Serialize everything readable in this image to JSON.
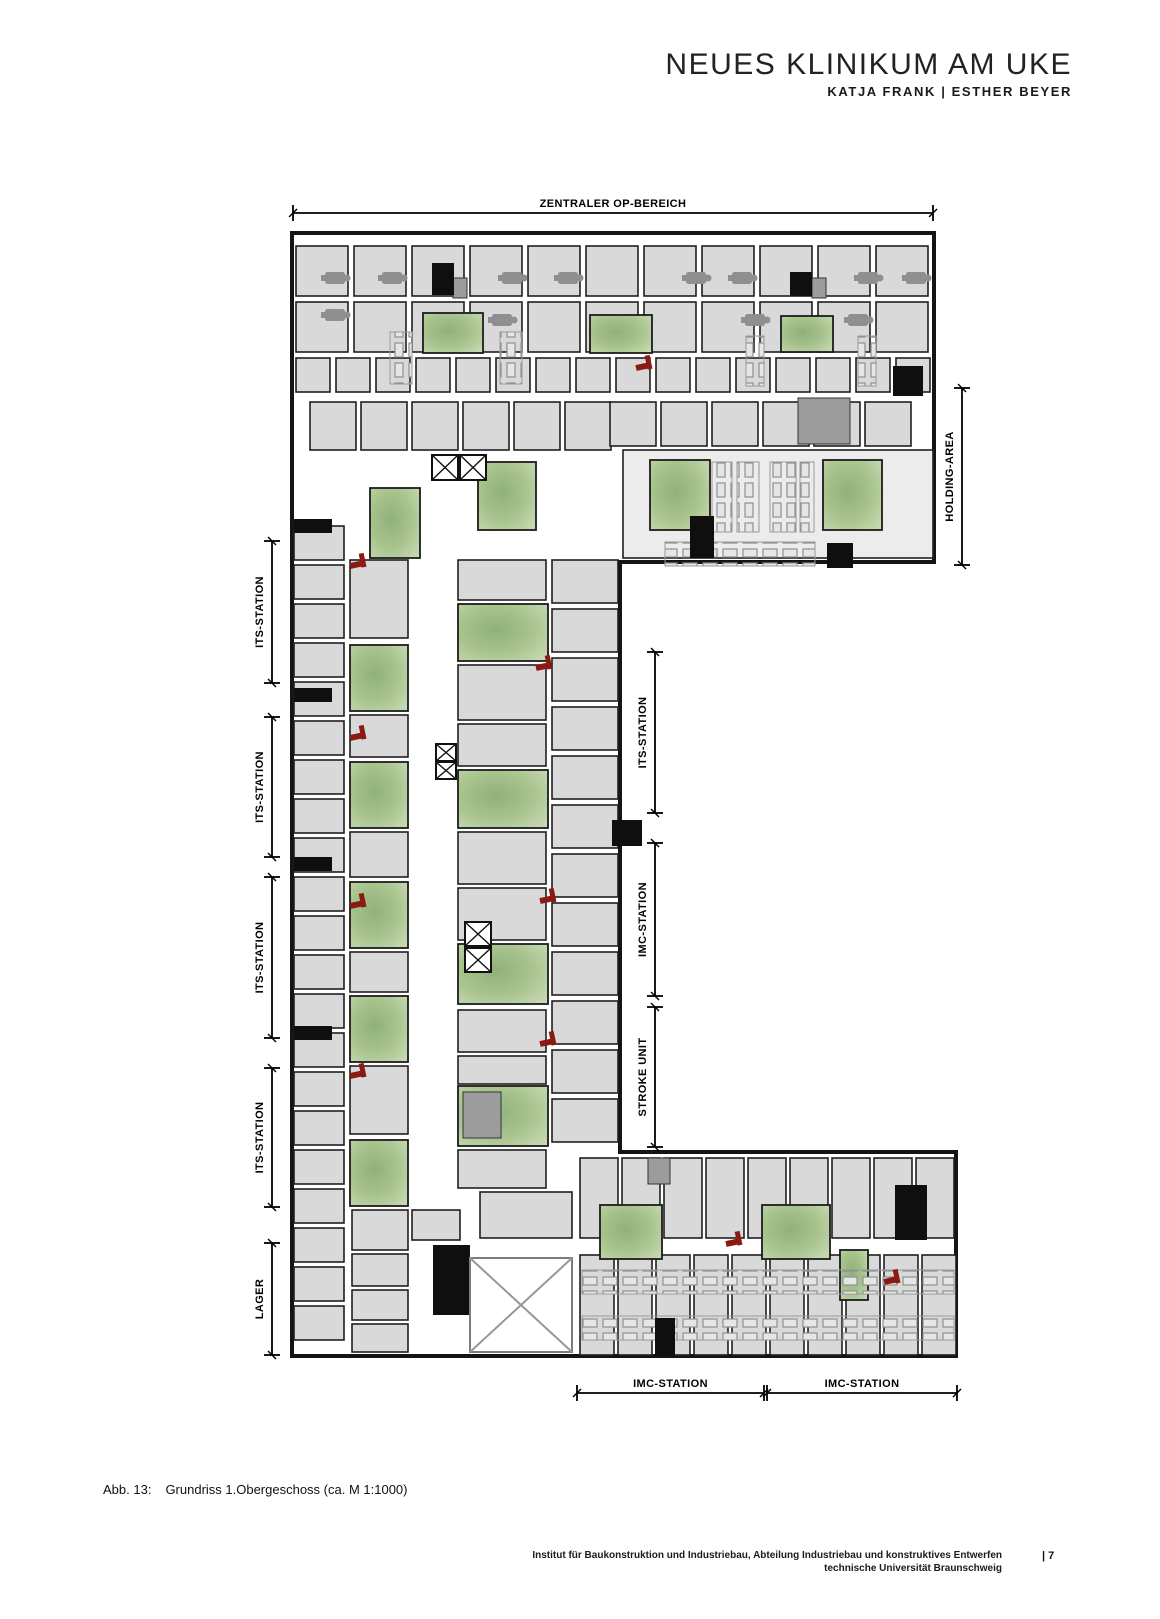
{
  "header": {
    "title": "NEUES KLINIKUM AM UKE",
    "subtitle": "KATJA FRANK | ESTHER BEYER"
  },
  "caption": {
    "label": "Abb. 13:",
    "text": "Grundriss 1.Obergeschoss (ca. M 1:1000)"
  },
  "footer": {
    "line1": "Institut für Baukonstruktion und Industriebau, Abteilung Industriebau und konstruktives Entwerfen",
    "line2": "technische Universität Braunschweig",
    "page": "| 7"
  },
  "colors": {
    "wall": "#141414",
    "room": "#d9d9d9",
    "room_light": "#ececec",
    "green_dark": "#90b07a",
    "green_mid": "#a9c48e",
    "green_light": "#c8dab4",
    "red": "#8b1a12",
    "gray": "#8f8f8f",
    "dim": "#000000"
  },
  "plan": {
    "outline": [
      [
        292,
        233
      ],
      [
        934,
        233
      ],
      [
        934,
        562
      ],
      [
        620,
        562
      ],
      [
        620,
        1152
      ],
      [
        956,
        1152
      ],
      [
        956,
        1356
      ],
      [
        292,
        1356
      ]
    ],
    "room_grids": [
      {
        "x": 296,
        "y": 246,
        "w": 52,
        "h": 50,
        "gap": 6,
        "cols": 11
      },
      {
        "x": 296,
        "y": 302,
        "w": 52,
        "h": 50,
        "gap": 6,
        "cols": 11
      },
      {
        "x": 296,
        "y": 358,
        "w": 34,
        "h": 34,
        "gap": 6,
        "cols": 16
      },
      {
        "x": 310,
        "y": 402,
        "w": 46,
        "h": 48,
        "gap": 5,
        "cols": 6
      },
      {
        "x": 610,
        "y": 402,
        "w": 46,
        "h": 44,
        "gap": 5,
        "cols": 6
      },
      {
        "x": 580,
        "y": 1158,
        "w": 38,
        "h": 80,
        "gap": 4,
        "cols": 9
      },
      {
        "x": 580,
        "y": 1255,
        "w": 34,
        "h": 100,
        "gap": 4,
        "cols": 10
      }
    ],
    "room_stacks": [
      {
        "x": 294,
        "y": 526,
        "w": 50,
        "h": 34,
        "gap": 5,
        "rows": 21
      },
      {
        "x": 552,
        "y": 560,
        "w": 66,
        "h": 43,
        "gap": 6,
        "rows": 12
      }
    ],
    "rooms": [
      [
        623,
        450,
        310,
        108,
        "light"
      ],
      [
        350,
        560,
        58,
        78
      ],
      [
        350,
        715,
        58,
        42
      ],
      [
        350,
        832,
        58,
        45
      ],
      [
        350,
        952,
        58,
        40
      ],
      [
        350,
        1066,
        58,
        68
      ],
      [
        352,
        1210,
        56,
        40
      ],
      [
        352,
        1254,
        56,
        32
      ],
      [
        352,
        1290,
        56,
        30
      ],
      [
        352,
        1324,
        56,
        28
      ],
      [
        458,
        560,
        88,
        40
      ],
      [
        458,
        665,
        88,
        55
      ],
      [
        458,
        724,
        88,
        42
      ],
      [
        458,
        832,
        88,
        52
      ],
      [
        458,
        888,
        88,
        52
      ],
      [
        458,
        1010,
        88,
        42
      ],
      [
        458,
        1056,
        88,
        28
      ],
      [
        458,
        1150,
        88,
        38
      ],
      [
        480,
        1192,
        92,
        46
      ],
      [
        412,
        1210,
        48,
        30
      ]
    ],
    "greens": [
      [
        423,
        313,
        60,
        40
      ],
      [
        590,
        315,
        62,
        38
      ],
      [
        781,
        316,
        52,
        36
      ],
      [
        370,
        488,
        50,
        70
      ],
      [
        478,
        462,
        58,
        68
      ],
      [
        650,
        460,
        60,
        70
      ],
      [
        823,
        460,
        59,
        70
      ],
      [
        350,
        645,
        58,
        66
      ],
      [
        350,
        762,
        58,
        66
      ],
      [
        350,
        882,
        58,
        66
      ],
      [
        350,
        996,
        58,
        66
      ],
      [
        350,
        1140,
        58,
        66
      ],
      [
        458,
        604,
        90,
        57
      ],
      [
        458,
        770,
        90,
        58
      ],
      [
        458,
        944,
        90,
        60
      ],
      [
        458,
        1086,
        90,
        60
      ],
      [
        600,
        1205,
        62,
        54
      ],
      [
        762,
        1205,
        68,
        54
      ],
      [
        840,
        1250,
        28,
        50
      ]
    ],
    "cores": [
      [
        432,
        263,
        22,
        32
      ],
      [
        790,
        272,
        22,
        24
      ],
      [
        893,
        366,
        30,
        30
      ],
      [
        690,
        516,
        24,
        42
      ],
      [
        827,
        543,
        26,
        25
      ],
      [
        294,
        519,
        38,
        14
      ],
      [
        294,
        688,
        38,
        14
      ],
      [
        294,
        857,
        38,
        14
      ],
      [
        294,
        1026,
        38,
        14
      ],
      [
        612,
        820,
        30,
        26
      ],
      [
        433,
        1245,
        37,
        70
      ],
      [
        895,
        1185,
        32,
        55
      ],
      [
        655,
        1318,
        20,
        38
      ]
    ],
    "gray_blocks": [
      [
        453,
        278,
        14,
        20
      ],
      [
        812,
        278,
        14,
        20
      ],
      [
        798,
        398,
        52,
        46
      ],
      [
        463,
        1092,
        38,
        46
      ],
      [
        648,
        1158,
        22,
        26
      ]
    ],
    "xboxes": [
      [
        432,
        455,
        26,
        25
      ],
      [
        460,
        455,
        26,
        25
      ],
      [
        436,
        744,
        20,
        17
      ],
      [
        436,
        762,
        20,
        17
      ],
      [
        465,
        922,
        26,
        24
      ],
      [
        465,
        948,
        26,
        24
      ]
    ],
    "atrium": [
      470,
      1258,
      102,
      94
    ],
    "tables": [
      [
        335,
        278
      ],
      [
        392,
        278
      ],
      [
        512,
        278
      ],
      [
        568,
        278
      ],
      [
        696,
        278
      ],
      [
        742,
        278
      ],
      [
        868,
        278
      ],
      [
        916,
        278
      ],
      [
        335,
        315
      ],
      [
        502,
        320
      ],
      [
        755,
        320
      ],
      [
        858,
        320
      ]
    ],
    "chairs": [
      [
        350,
        566
      ],
      [
        536,
        668
      ],
      [
        350,
        738
      ],
      [
        350,
        906
      ],
      [
        540,
        901
      ],
      [
        350,
        1076
      ],
      [
        540,
        1044
      ],
      [
        726,
        1244
      ],
      [
        884,
        1282
      ],
      [
        636,
        368
      ]
    ],
    "bed_strips_v": [
      [
        712,
        462,
        20,
        70
      ],
      [
        737,
        462,
        22,
        70
      ],
      [
        770,
        462,
        26,
        70
      ],
      [
        800,
        462,
        14,
        70
      ],
      [
        390,
        332,
        22,
        52
      ],
      [
        500,
        332,
        22,
        52
      ],
      [
        746,
        336,
        18,
        50
      ],
      [
        858,
        336,
        18,
        50
      ]
    ],
    "bed_strips_h": [
      [
        665,
        542,
        150,
        24
      ],
      [
        582,
        1270,
        372,
        24
      ],
      [
        582,
        1316,
        372,
        24
      ]
    ]
  },
  "dimensions": [
    {
      "label": "ZENTRALER OP-BEREICH",
      "type": "h",
      "x": 293,
      "y": 213,
      "len": 640
    },
    {
      "label": "HOLDING-AREA",
      "type": "v",
      "x": 962,
      "y": 388,
      "len": 177
    },
    {
      "label": "ITS-STATION",
      "type": "v",
      "x": 272,
      "y": 541,
      "len": 142
    },
    {
      "label": "ITS-STATION",
      "type": "v",
      "x": 272,
      "y": 717,
      "len": 140
    },
    {
      "label": "ITS-STATION",
      "type": "v",
      "x": 272,
      "y": 877,
      "len": 161
    },
    {
      "label": "ITS-STATION",
      "type": "v",
      "x": 272,
      "y": 1068,
      "len": 139
    },
    {
      "label": "LAGER",
      "type": "v",
      "x": 272,
      "y": 1243,
      "len": 112
    },
    {
      "label": "ITS-STATION",
      "type": "v",
      "x": 655,
      "y": 652,
      "len": 161
    },
    {
      "label": "IMC-STATION",
      "type": "v",
      "x": 655,
      "y": 843,
      "len": 153
    },
    {
      "label": "STROKE UNIT",
      "type": "v",
      "x": 655,
      "y": 1007,
      "len": 140
    },
    {
      "label": "IMC-STATION",
      "type": "h",
      "x": 577,
      "y": 1393,
      "len": 187
    },
    {
      "label": "IMC-STATION",
      "type": "h",
      "x": 767,
      "y": 1393,
      "len": 190
    }
  ]
}
